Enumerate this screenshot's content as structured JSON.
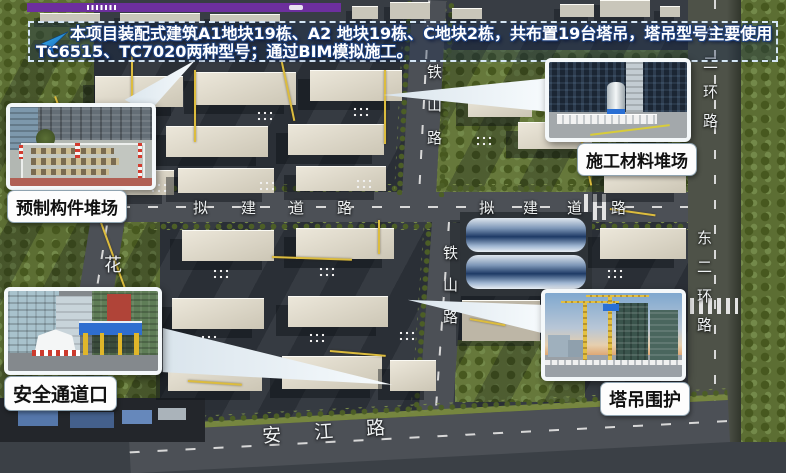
{
  "slide": {
    "progress_bar_color": "#6d2f9e"
  },
  "banner": {
    "icon": "paper-plane-arrow",
    "line1": "本项目装配式建筑A1地块19栋、A2 地块19栋、C地块2栋，共布置19台塔吊，塔吊型号主要使用",
    "line2": "TC6515、TC7020两种型号；通过BIM模拟施工。"
  },
  "callouts": {
    "prefab_yard": {
      "label": "预制构件堆场"
    },
    "material_yard": {
      "label": "施工材料堆场"
    },
    "safety_passage": {
      "label": "安全通道口"
    },
    "crane_enclosure": {
      "label": "塔吊围护"
    }
  },
  "map_labels": {
    "tieshan_road_upper": "铁山路",
    "tieshan_road_lower": "铁山路",
    "proposed_road_west": "拟建道路",
    "proposed_road_east": "拟建道路",
    "hua_road": "花",
    "east_second_ring_road_upper": "东二环路",
    "east_second_ring_road_lower": "东二环路",
    "anjiang_road": "安江路"
  },
  "colors": {
    "crane_leader_line": "#dcbc3e",
    "banner_border": "#d5e6f5",
    "pointer_fill": "#edf3f8"
  }
}
